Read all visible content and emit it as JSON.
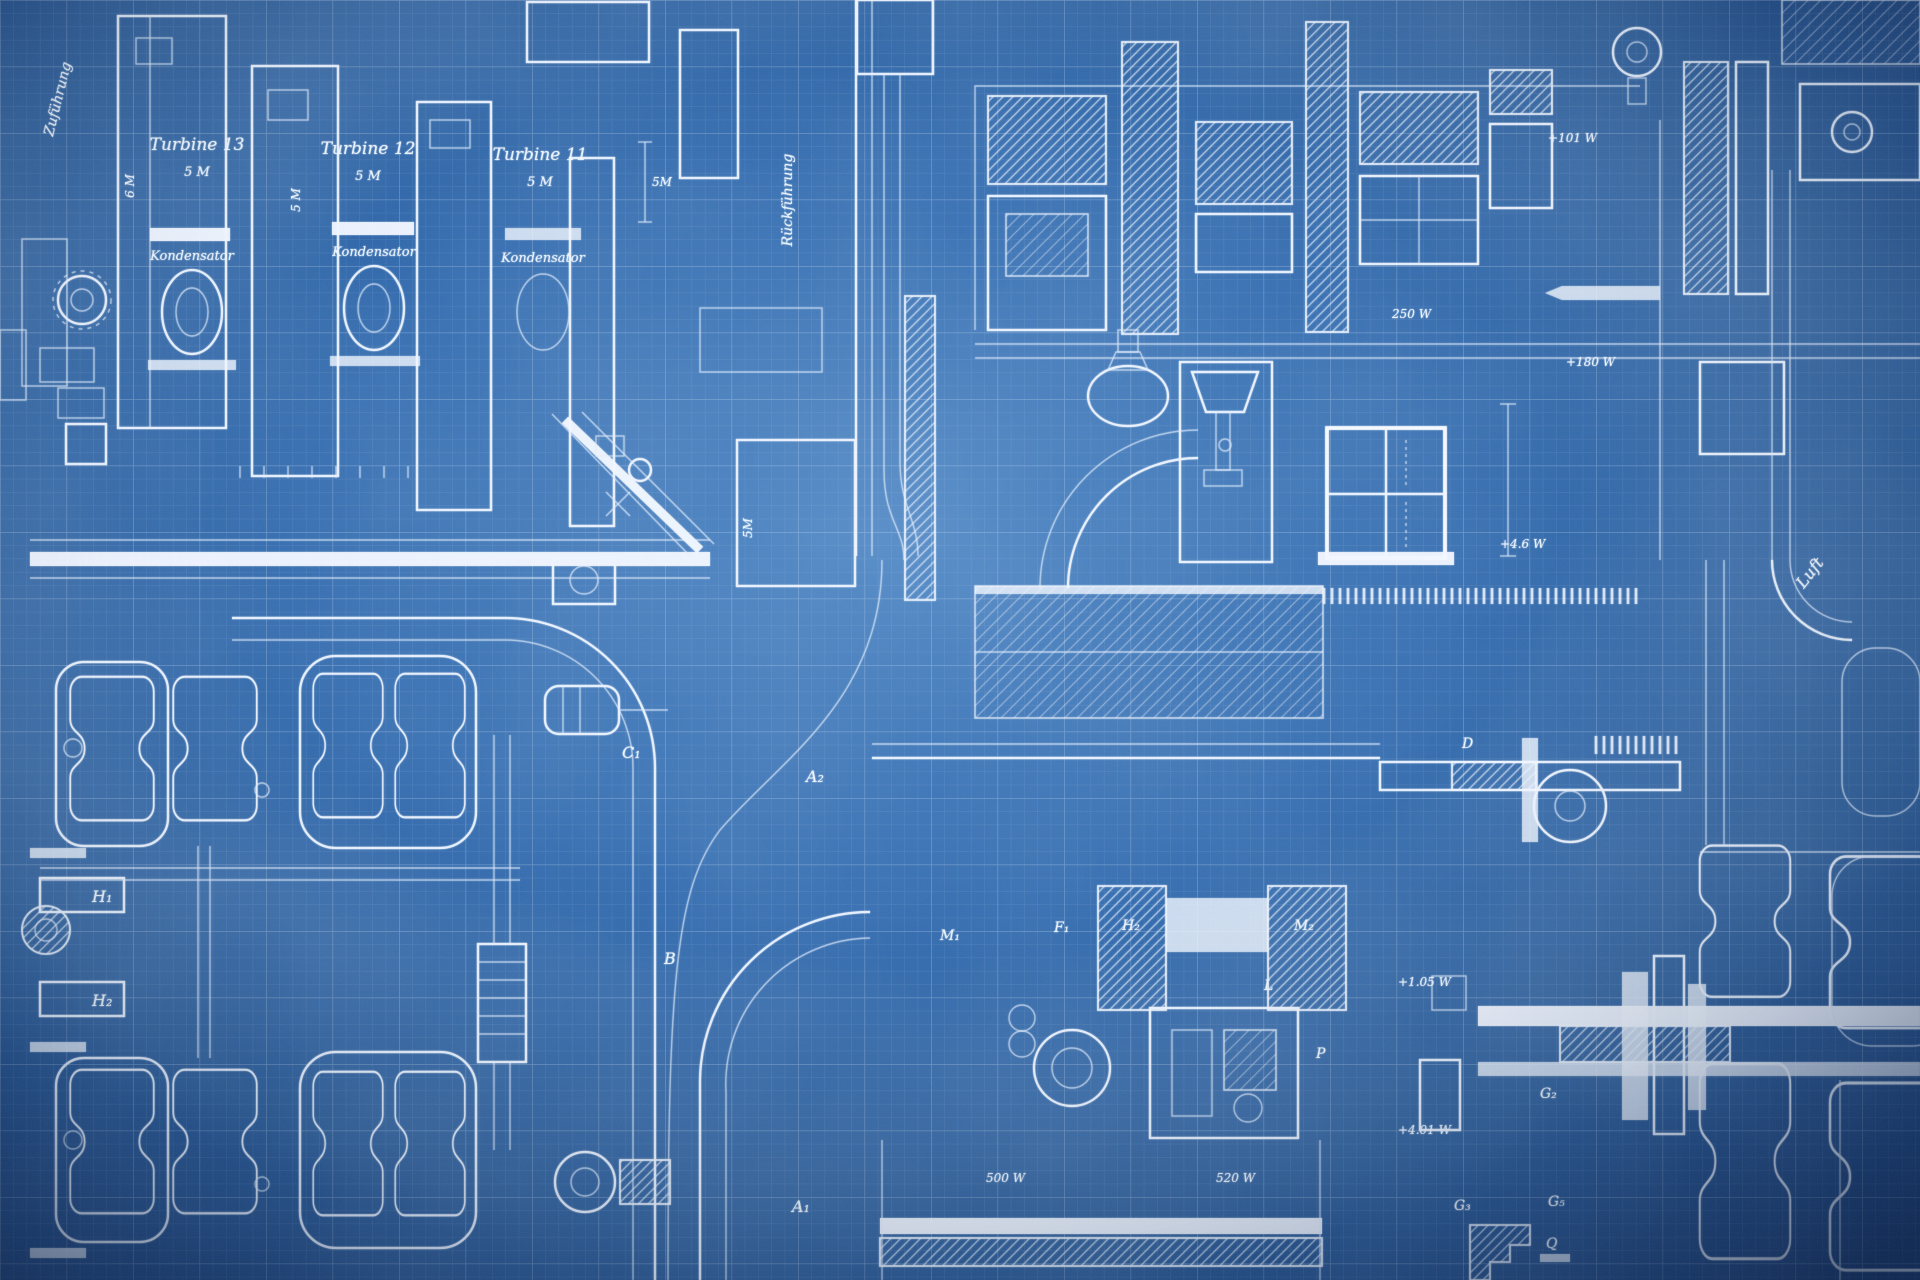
{
  "canvas": {
    "width": 1920,
    "height": 1280,
    "kind": "engineering blueprint drawing"
  },
  "colors": {
    "paper_center": "#3c78bc",
    "paper_mid": "#2e68ad",
    "paper_edge": "#173f7c",
    "paper_corner": "#102f63",
    "ink": "#eef6ff",
    "grid": "#d7e7fb"
  },
  "labels": {
    "feed_rotated": "Zuführung",
    "return_rotated": "Rückführung",
    "air_rotated": "Luft",
    "turbine1_name": "Turbine 13",
    "turbine1_dim": "5 M",
    "turbine2_name": "Turbine 12",
    "turbine2_dim": "5 M",
    "turbine3_name": "Turbine 11",
    "turbine3_dim": "5 M",
    "condenser1": "Kondensator",
    "condenser2": "Kondensator",
    "condenser3": "Kondensator",
    "h1": "H₁",
    "h2": "H₂",
    "c1": "C₁",
    "a1": "A₁",
    "a2": "A₂",
    "b": "B",
    "m1": "M₁",
    "f1": "F₁",
    "h2_block": "H₂",
    "m2_block": "M₂",
    "l": "L",
    "p": "P",
    "d": "D",
    "g2": "G₂",
    "g3": "G₃",
    "g5": "G₅",
    "q": "Q"
  },
  "annotations": {
    "w101": "+101 W",
    "w250": "250 W",
    "w180": "+180 W",
    "w46": "+4.6 W",
    "w105": "+1.05 W",
    "w401": "+4.01 W",
    "w500": "500 W",
    "w520": "520 W",
    "dim_col_a": "6 M",
    "dim_col_b": "5 M",
    "dim_a": "5M",
    "dim_b": "5M"
  }
}
